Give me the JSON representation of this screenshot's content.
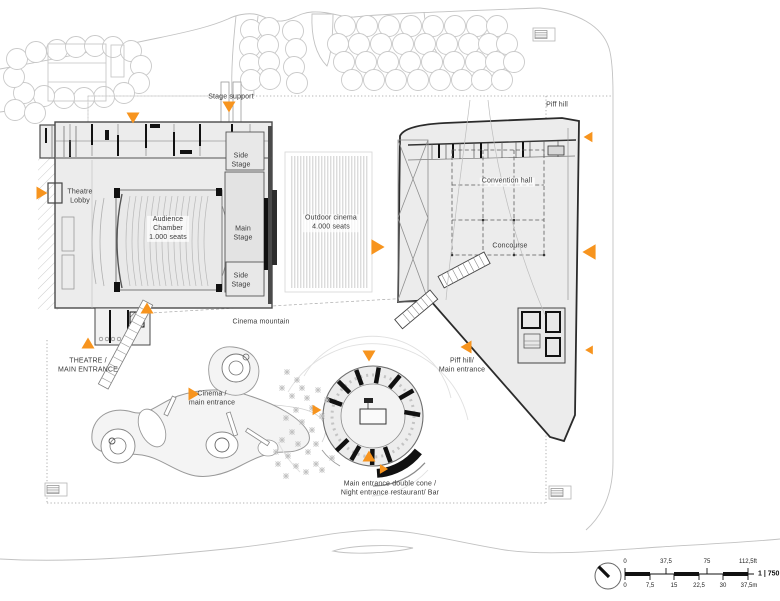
{
  "plan": {
    "labels": {
      "stage_support": "Stage support",
      "piff_hill": "Piff hill",
      "theatre_lobby": "Theatre\nLobby",
      "side_stage_top": "Side\nStage",
      "audience_chamber": "Audience\nChamber\n1.000 seats",
      "main_stage": "Main\nStage",
      "side_stage_bottom": "Side\nStage",
      "outdoor_cinema": "Outdoor cinema\n4.000 seats",
      "convention_hall": "Convention hall",
      "concourse": "Concourse",
      "cinema_mountain": "Cinema mountain",
      "theatre_main_entrance": "THEATRE /\nMAIN ENTRANCE",
      "cinema_main_entrance": "Cinema /\nmain entrance",
      "piff_hill_entrance": "Piff hill/\nMain entrance",
      "double_cone": "Main entrance double cone /\nNight entrance restaurant/ Bar"
    },
    "scalebar": {
      "ft_ticks": [
        "0",
        "37,5",
        "75",
        "112,5ft"
      ],
      "m_ticks": [
        "0",
        "7,5",
        "15",
        "22,5",
        "30",
        "37,5m"
      ],
      "ratio": "1 | 750"
    },
    "colors": {
      "entrance_marker": "#F7941E",
      "building_fill": "#ECECEC",
      "stage_fill": "#E3E3E3",
      "wall": "#2B2B2B",
      "context_line": "#C2C2C2"
    }
  }
}
